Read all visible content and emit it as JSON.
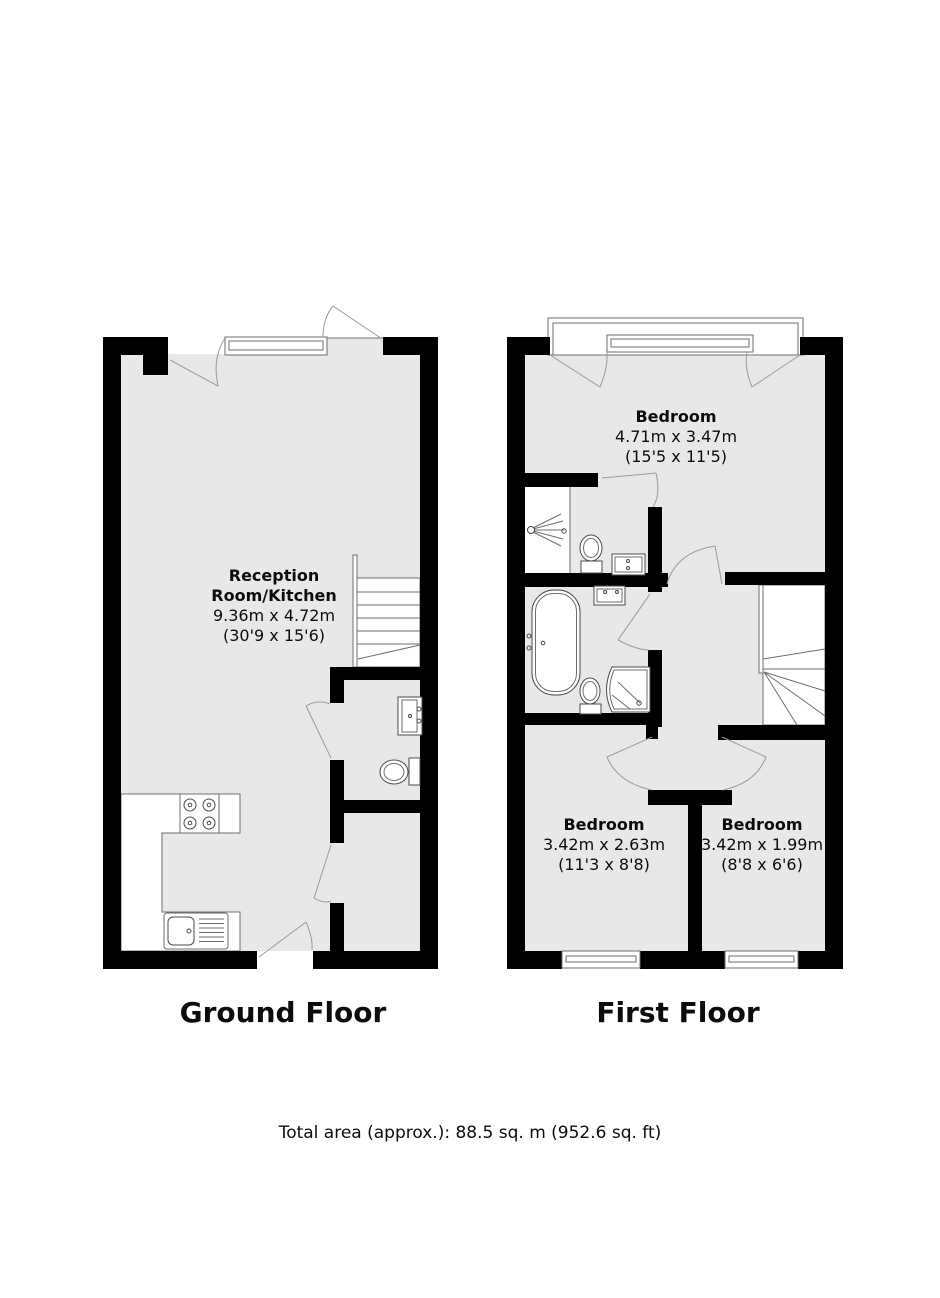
{
  "colors": {
    "wall": "#000000",
    "floor": "#e8e8e8",
    "outline": "#6e6e6e",
    "door_arc": "#9a9a9a"
  },
  "ground_floor": {
    "title": "Ground Floor",
    "rooms": [
      {
        "name": "Reception Room/Kitchen",
        "dimensions_metric": "9.36m x 4.72m",
        "dimensions_imperial": "(30'9 x 15'6)"
      }
    ],
    "fixtures": [
      "window",
      "staircase",
      "kitchen-counter",
      "hob",
      "kitchen-sink",
      "wc-basin",
      "wc-toilet",
      "door-swings"
    ]
  },
  "first_floor": {
    "title": "First Floor",
    "rooms": [
      {
        "name": "Bedroom",
        "dimensions_metric": "4.71m x 3.47m",
        "dimensions_imperial": "(15'5 x 11'5)"
      },
      {
        "name": "Bedroom",
        "dimensions_metric": "3.42m x 2.63m",
        "dimensions_imperial": "(11'3 x 8'8)"
      },
      {
        "name": "Bedroom",
        "dimensions_metric": "3.42m x 1.99m",
        "dimensions_imperial": "(8'8 x 6'6)"
      }
    ],
    "fixtures": [
      "bay-window",
      "staircase",
      "shower",
      "shower-room-toilet",
      "shower-room-basin",
      "bathtub",
      "bathroom-basin",
      "bathroom-toilet",
      "corner-shower",
      "bedroom-windows",
      "door-swings"
    ]
  },
  "footer": {
    "total_area": "Total area (approx.): 88.5 sq. m (952.6 sq. ft)"
  }
}
